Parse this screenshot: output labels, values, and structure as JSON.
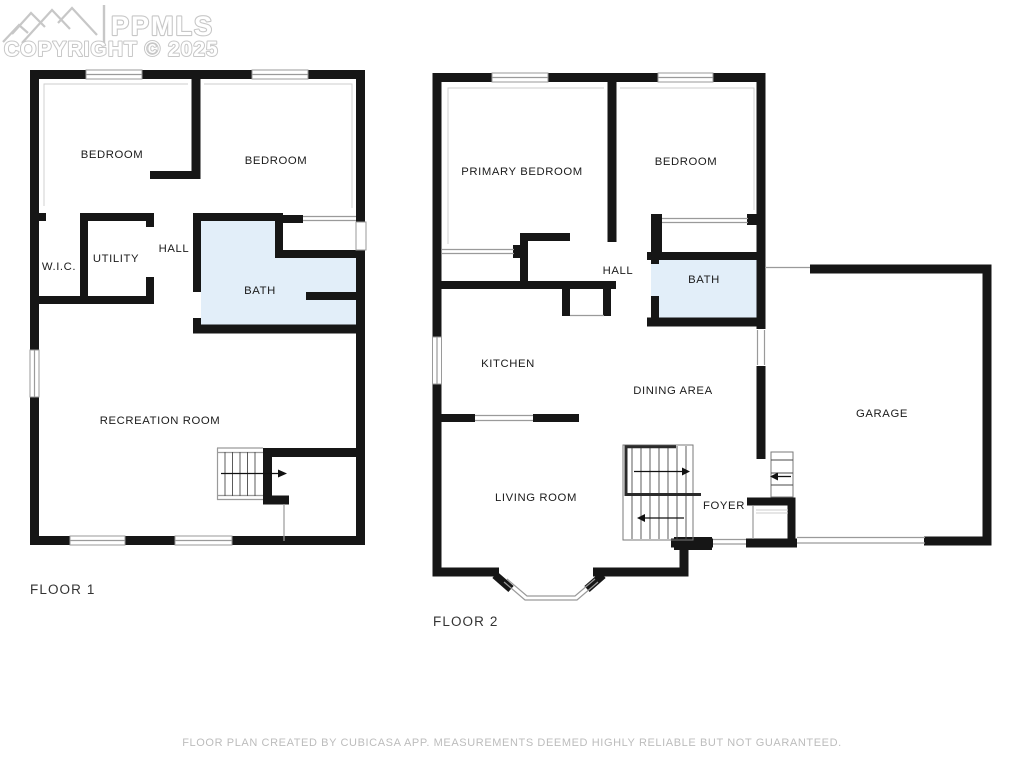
{
  "watermark": {
    "brand": "PPMLS",
    "copyright_line": "COPYRIGHT © 2025"
  },
  "floor1": {
    "label": "FLOOR 1",
    "rooms": [
      {
        "label": "BEDROOM"
      },
      {
        "label": "BEDROOM"
      },
      {
        "label": "W.I.C."
      },
      {
        "label": "UTILITY"
      },
      {
        "label": "HALL"
      },
      {
        "label": "BATH"
      },
      {
        "label": "RECREATION ROOM"
      }
    ]
  },
  "floor2": {
    "label": "FLOOR 2",
    "rooms": [
      {
        "label": "PRIMARY BEDROOM"
      },
      {
        "label": "BEDROOM"
      },
      {
        "label": "HALL"
      },
      {
        "label": "BATH"
      },
      {
        "label": "KITCHEN"
      },
      {
        "label": "DINING AREA"
      },
      {
        "label": "LIVING ROOM"
      },
      {
        "label": "FOYER"
      },
      {
        "label": "GARAGE"
      }
    ]
  },
  "footer": {
    "disclaimer": "FLOOR PLAN CREATED BY CUBICASA APP. MEASUREMENTS DEEMED HIGHLY RELIABLE BUT NOT GUARANTEED."
  },
  "colors": {
    "wall": "#161616",
    "bath_fill": "#e2eef9",
    "thin_line": "#9a9a9a",
    "watermark": "#c7c7c7",
    "footer_text": "#bcbcbc",
    "room_label_text": "#1b1b1b",
    "floor_label_text": "#333333"
  }
}
